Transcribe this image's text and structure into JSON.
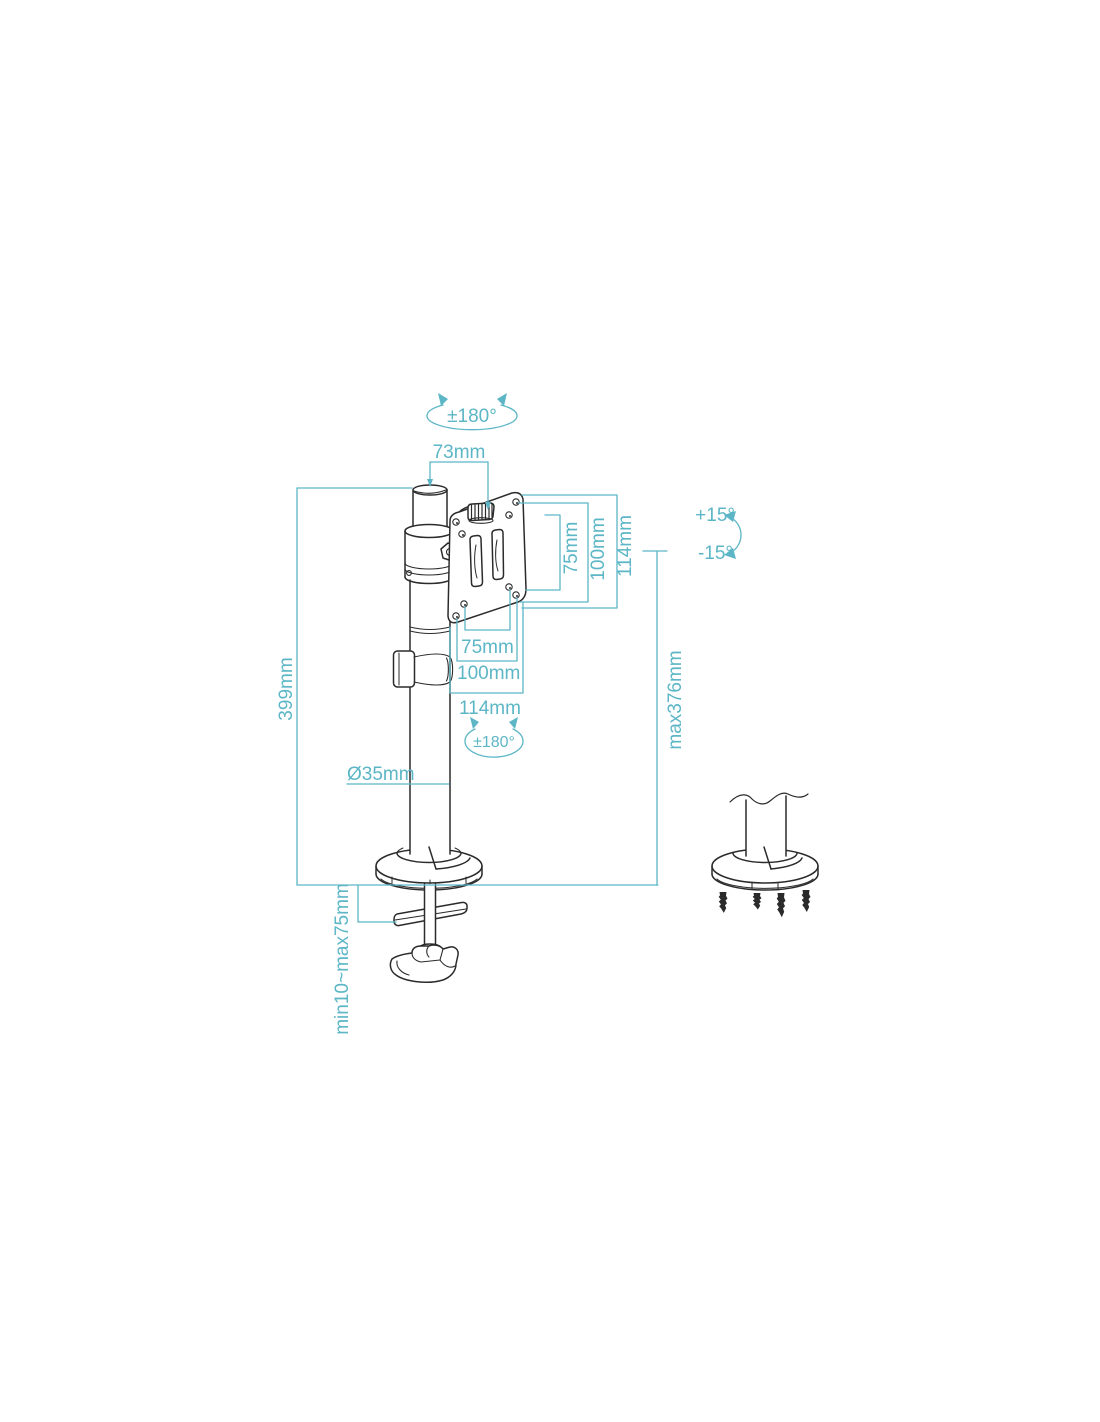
{
  "diagram": {
    "title_hint": "monitor desk mount dimension drawing",
    "accent_color": "#5cb6c6",
    "line_color": "#2b2b2b",
    "labels": {
      "rotation_top": "±180°",
      "rotation_mid": "±180°",
      "arm_offset": "73mm",
      "vesa_vertical_75": "75mm",
      "vesa_vertical_100": "100mm",
      "vesa_vertical_114": "114mm",
      "vesa_horizontal_75": "75mm",
      "vesa_horizontal_100": "100mm",
      "vesa_horizontal_114": "114mm",
      "tilt_up": "+15°",
      "tilt_down": "-15°",
      "pole_height": "399mm",
      "pole_diameter": "Ø35mm",
      "max_height": "max376mm",
      "clamp_range": "min10~max75mm"
    }
  }
}
